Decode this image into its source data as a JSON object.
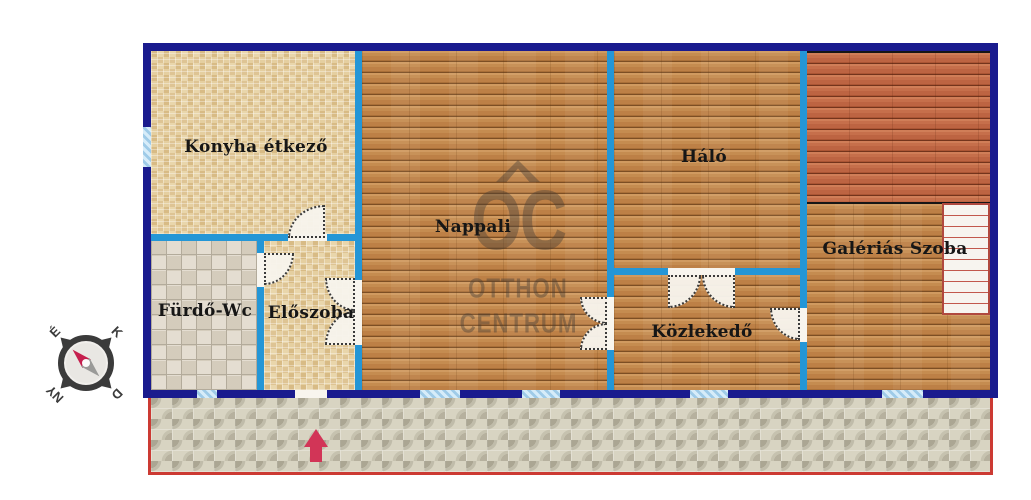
{
  "plan": {
    "rooms": {
      "kitchen": "Konyha étkező",
      "living_room": "Nappali",
      "bedroom": "Háló",
      "gallery_room": "Galériás Szoba",
      "bathroom": "Fürdő-Wc",
      "entry_hall": "Előszoba",
      "corridor": "Közlekedő"
    },
    "compass": {
      "north": "É",
      "east": "K",
      "south": "D",
      "west": "NY"
    },
    "watermark": {
      "monogram": "OC",
      "line1": "OTTHON",
      "line2": "CENTRUM"
    },
    "colors": {
      "exterior_wall": "#1a1b8e",
      "interior_wall": "#2496d6",
      "window_fill": "#9fcbe8",
      "terrace_border": "#cc3a33",
      "entrance_arrow": "#d23557",
      "compass_needle_north": "#c51f4e",
      "gallery_floor": "#c2694a",
      "stair_outline": "#b0493f"
    }
  }
}
